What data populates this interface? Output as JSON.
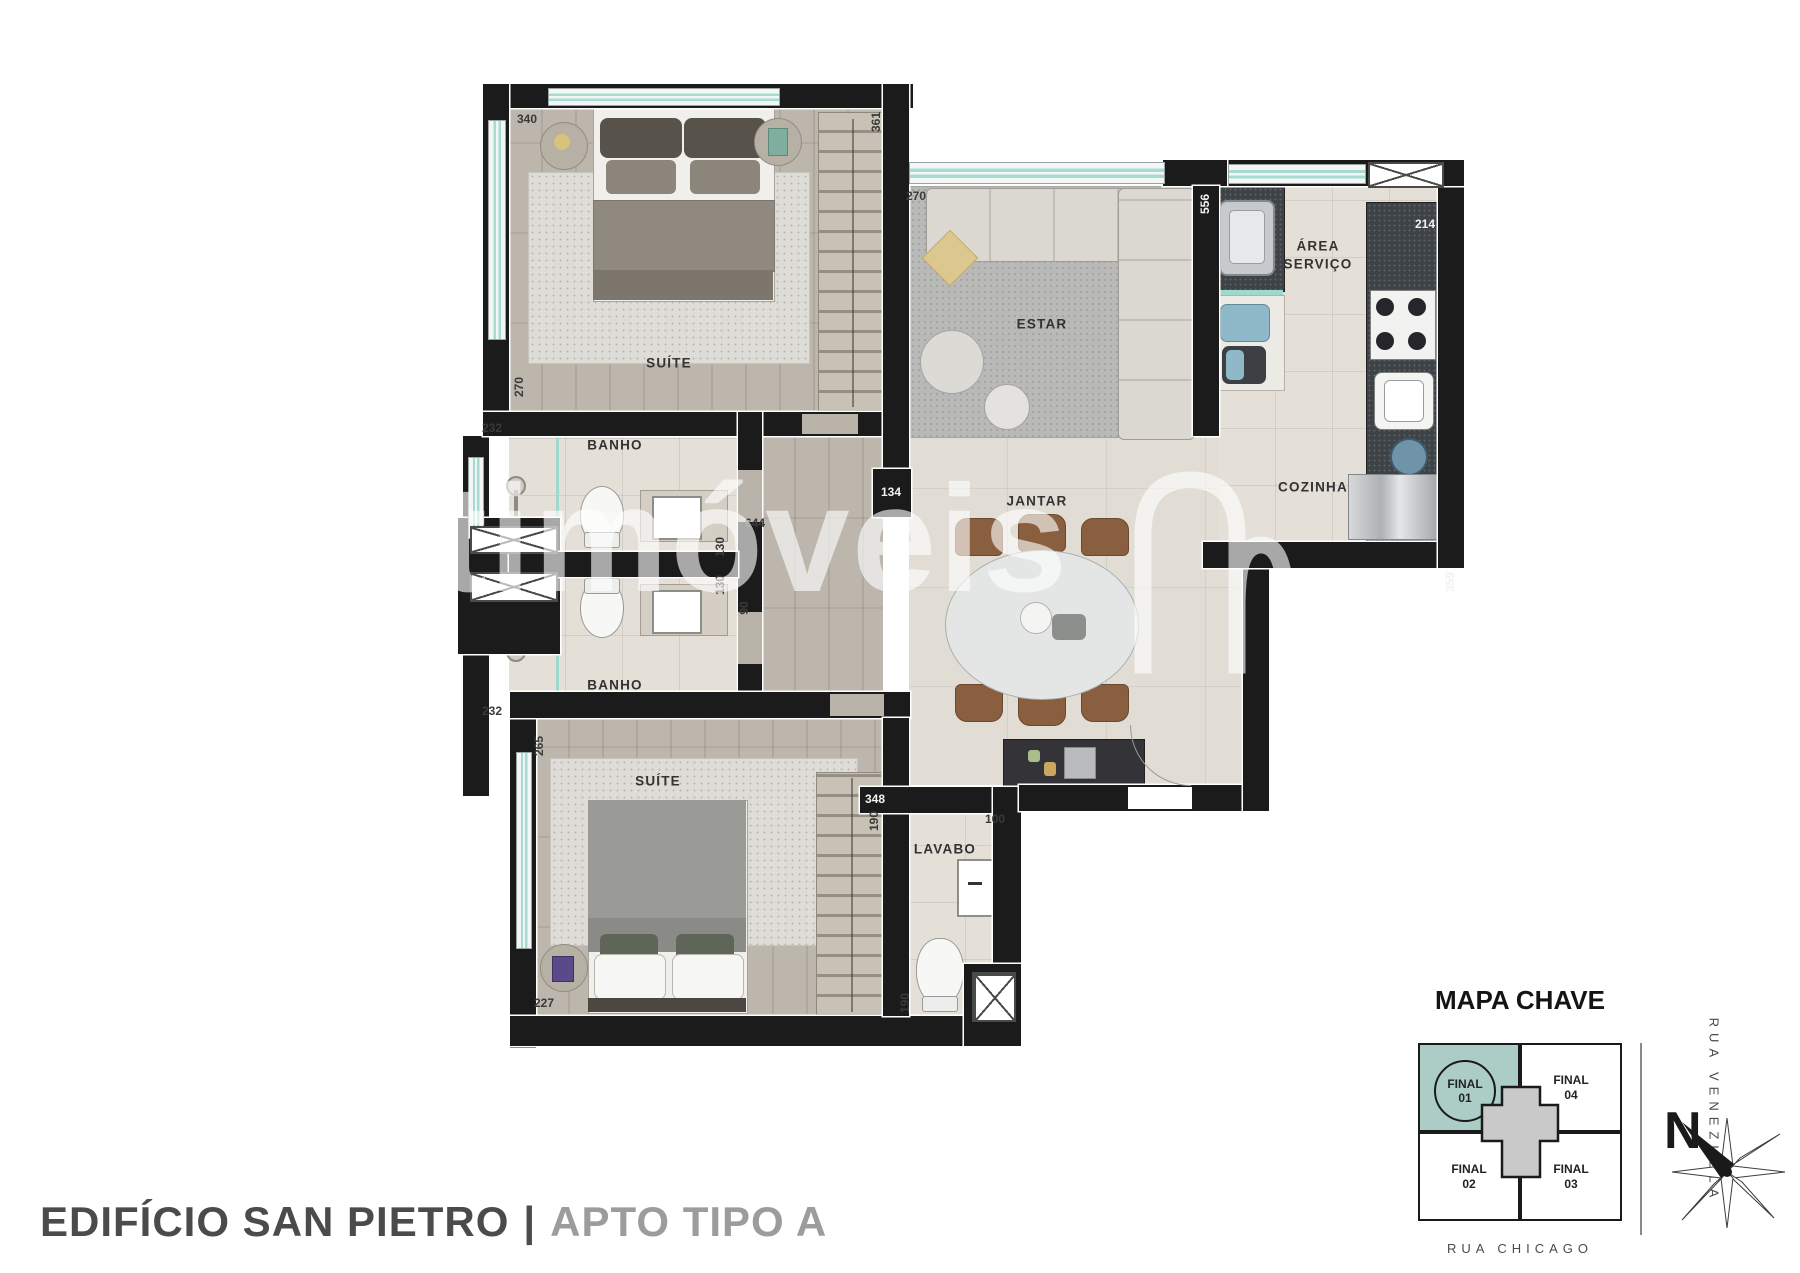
{
  "footer": {
    "building": "EDIFÍCIO SAN PIETRO",
    "separator": "|",
    "unit": "APTO TIPO A"
  },
  "watermark": {
    "text": "netimóveis"
  },
  "floor_plan": {
    "room_labels": [
      {
        "text": "SUÍTE",
        "x": 241,
        "y": 291,
        "wrap": false
      },
      {
        "text": "BANHO",
        "x": 187,
        "y": 373,
        "wrap": false
      },
      {
        "text": "BANHO",
        "x": 187,
        "y": 613,
        "wrap": false
      },
      {
        "text": "SUÍTE",
        "x": 230,
        "y": 709,
        "wrap": false
      },
      {
        "text": "LAVABO",
        "x": 517,
        "y": 777,
        "wrap": false
      },
      {
        "text": "ESTAR",
        "x": 614,
        "y": 252,
        "wrap": false
      },
      {
        "text": "JANTAR",
        "x": 609,
        "y": 429,
        "wrap": false
      },
      {
        "text": "COZINHA",
        "x": 885,
        "y": 415,
        "wrap": false
      },
      {
        "text": "ÁREA SERVIÇO",
        "x": 890,
        "y": 183,
        "wrap": true
      }
    ],
    "dimensions": [
      {
        "value": "340",
        "x": 99,
        "y": 47,
        "rot": 0,
        "light": false
      },
      {
        "value": "361",
        "x": 448,
        "y": 50,
        "rot": 1,
        "light": false
      },
      {
        "value": "270",
        "x": 488,
        "y": 124,
        "rot": 0,
        "light": false
      },
      {
        "value": "556",
        "x": 777,
        "y": 132,
        "rot": 1,
        "light": true
      },
      {
        "value": "214",
        "x": 997,
        "y": 152,
        "rot": 0,
        "light": true
      },
      {
        "value": "232",
        "x": 64,
        "y": 356,
        "rot": 0,
        "light": false
      },
      {
        "value": "270",
        "x": 91,
        "y": 315,
        "rot": 1,
        "light": false
      },
      {
        "value": "644",
        "x": 327,
        "y": 451,
        "rot": 0,
        "light": false
      },
      {
        "value": "130",
        "x": 292,
        "y": 475,
        "rot": 1,
        "light": false
      },
      {
        "value": "130",
        "x": 292,
        "y": 513,
        "rot": 1,
        "light": false
      },
      {
        "value": "90",
        "x": 316,
        "y": 536,
        "rot": 1,
        "light": false
      },
      {
        "value": "134",
        "x": 463,
        "y": 420,
        "rot": 0,
        "light": true
      },
      {
        "value": "232",
        "x": 64,
        "y": 639,
        "rot": 0,
        "light": false
      },
      {
        "value": "265",
        "x": 111,
        "y": 674,
        "rot": 1,
        "light": false
      },
      {
        "value": "227",
        "x": 116,
        "y": 931,
        "rot": 0,
        "light": false
      },
      {
        "value": "348",
        "x": 447,
        "y": 727,
        "rot": 0,
        "light": true
      },
      {
        "value": "190",
        "x": 446,
        "y": 749,
        "rot": 1,
        "light": false
      },
      {
        "value": "100",
        "x": 567,
        "y": 747,
        "rot": 0,
        "light": false
      },
      {
        "value": "190",
        "x": 477,
        "y": 931,
        "rot": 1,
        "light": false
      },
      {
        "value": "359",
        "x": 1022,
        "y": 510,
        "rot": 1,
        "light": true
      }
    ]
  },
  "key_map": {
    "title": "MAPA CHAVE",
    "units": [
      {
        "label": "FINAL 01",
        "highlighted": true
      },
      {
        "label": "FINAL 04",
        "highlighted": false
      },
      {
        "label": "FINAL 02",
        "highlighted": false
      },
      {
        "label": "FINAL 03",
        "highlighted": false
      }
    ],
    "streets": {
      "right": "RUA VENEZUELA",
      "bottom": "RUA CHICAGO"
    },
    "compass": "N",
    "highlight_color": "#accdc5"
  }
}
